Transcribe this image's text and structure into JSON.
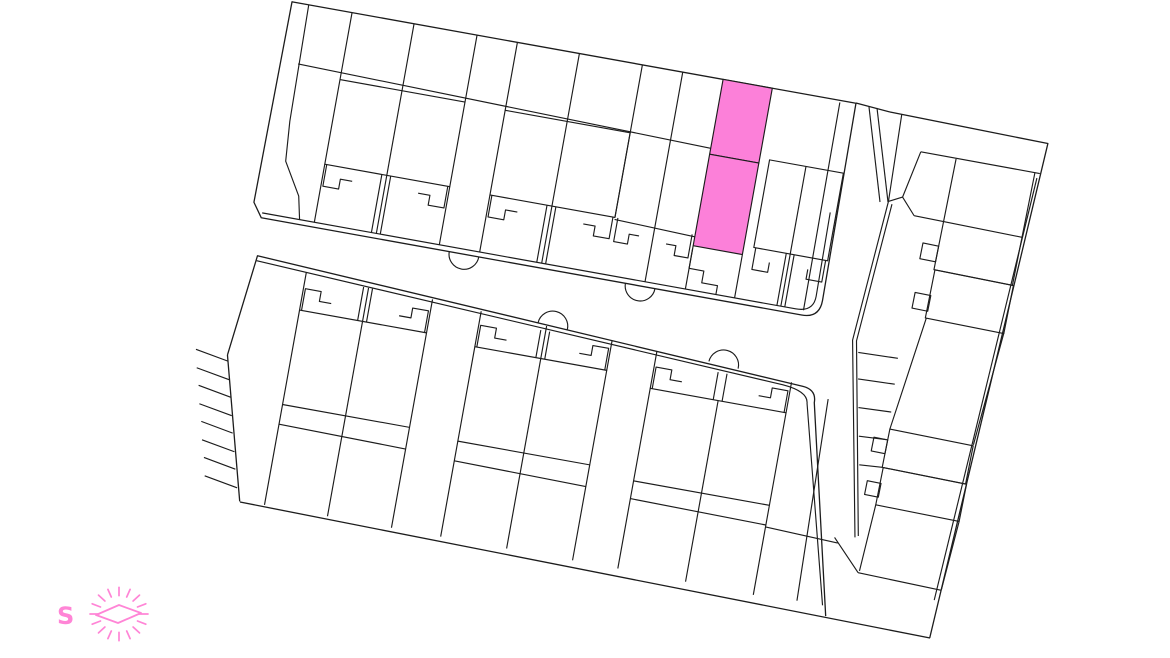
{
  "canvas": {
    "width": 1170,
    "height": 658,
    "background": "#ffffff"
  },
  "palette": {
    "line": "#1c1c1c",
    "highlight_fill": "#fc80d9",
    "compass_pink": "#ff85d6"
  },
  "compass": {
    "label": "S"
  },
  "highlighted_plot": {
    "name": "available-plot",
    "parcels": [
      {
        "id": "rear-garden-parcel",
        "points": "437,0 487,0 487,76 437,76"
      },
      {
        "id": "house-parcel",
        "points": "437,76 487,76 487,169 437,169"
      }
    ]
  }
}
